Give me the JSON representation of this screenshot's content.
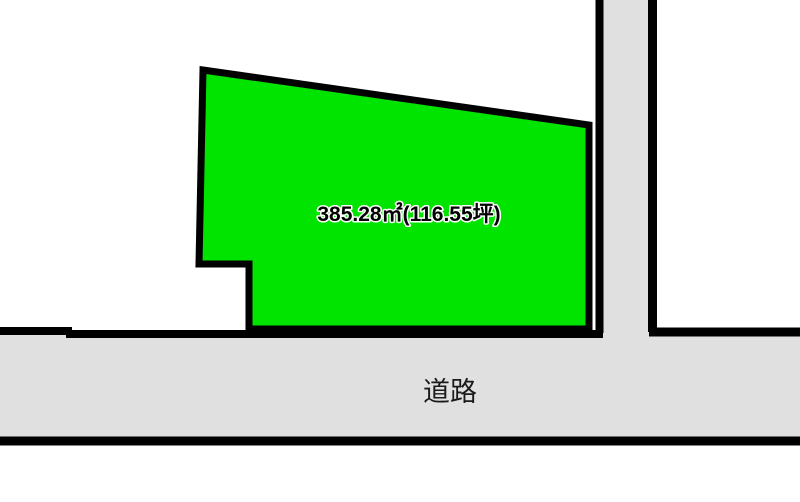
{
  "parcel": {
    "area_label": "385.28㎡(116.55坪)",
    "fill_color": "#00e400"
  },
  "road": {
    "label": "道路",
    "fill_color": "#e0e0e0"
  },
  "colors": {
    "outline": "#000000",
    "background": "#ffffff"
  }
}
